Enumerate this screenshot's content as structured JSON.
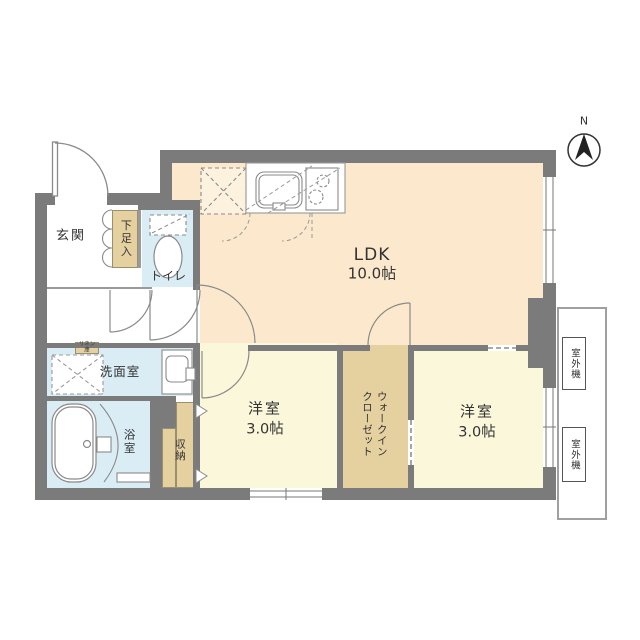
{
  "plan": {
    "compass": "N",
    "rooms": {
      "ldk": {
        "name": "LDK",
        "size": "10.0帖"
      },
      "bedroom1": {
        "name": "洋室",
        "size": "3.0帖"
      },
      "bedroom2": {
        "name": "洋室",
        "size": "3.0帖"
      },
      "wic": {
        "name": "ウォークイン\nクローゼット"
      },
      "entrance": {
        "name": "玄関"
      },
      "shoe": {
        "name": "下足入"
      },
      "toilet": {
        "name": "トイレ"
      },
      "washroom": {
        "name": "洗面室"
      },
      "bath": {
        "name": "浴室"
      },
      "storage": {
        "name": "収納"
      },
      "linen": {
        "name": "リネン庫"
      },
      "outdoor_unit_1": {
        "name": "室外機"
      },
      "outdoor_unit_2": {
        "name": "室外機"
      }
    },
    "colors": {
      "wall": "#7b7b7b",
      "ldk": "#fce9cd",
      "bedroom": "#faf7da",
      "closet": "#e5d0a0",
      "wet_area": "#daedf4"
    }
  }
}
